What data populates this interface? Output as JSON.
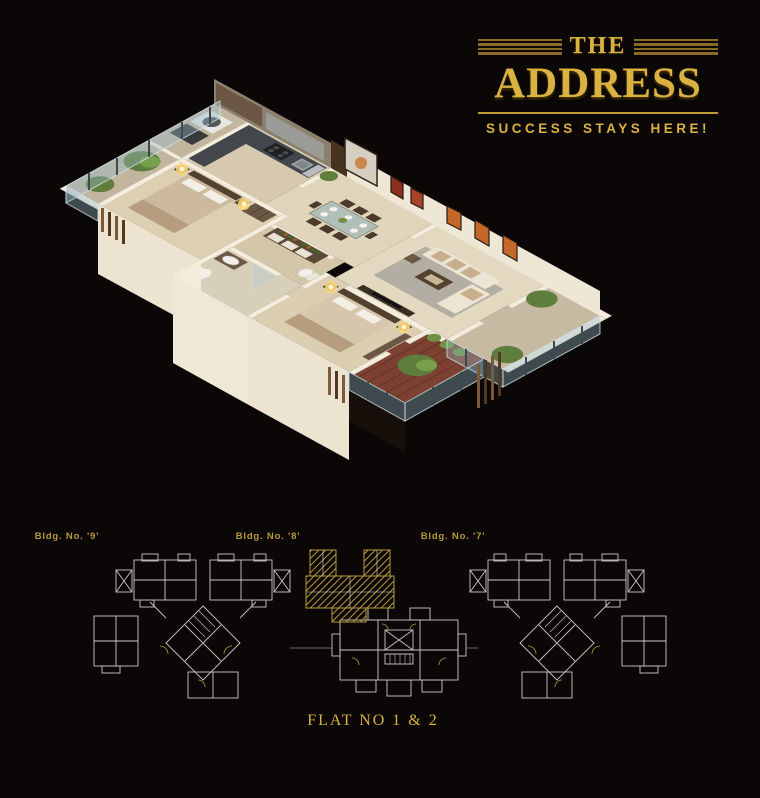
{
  "brand": {
    "prefix": "THE",
    "name": "ADDRESS",
    "tagline": "SUCCESS STAYS HERE!"
  },
  "site_plan": {
    "building_labels": [
      "Bldg. No. '9'",
      "Bldg. No. '8'",
      "Bldg. No. '7'"
    ],
    "highlighted_building": "Bldg. No. '8'",
    "flat_caption": "FLAT NO 1 & 2"
  },
  "colors": {
    "background": "#0a0706",
    "gold": "#d9b242",
    "gold_dark": "#8a6c28",
    "gold_line": "#bf9a33",
    "hatch_gold": "#b89a3a",
    "plan_line": "#c9c9c9",
    "wall_cream": "#f3ecdc",
    "floor_beige": "#dccfb2",
    "wood_dark": "#5d4a36",
    "deck_wood": "#7c4130",
    "glass_blue": "#9bb9c8",
    "plant_green": "#5f7d3c"
  }
}
